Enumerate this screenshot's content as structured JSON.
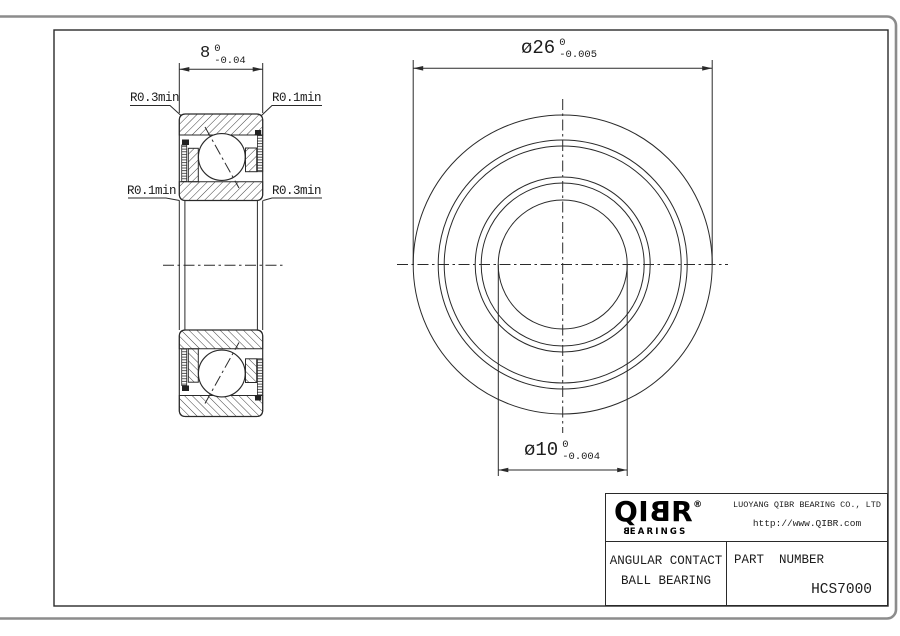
{
  "drawing": {
    "side_view": {
      "width_dim": {
        "value": "8",
        "tol_upper": "0",
        "tol_lower": "-0.04"
      },
      "radius_labels": {
        "top_left": "R0.3min",
        "top_right": "R0.1min",
        "bottom_left": "R0.1min",
        "bottom_right": "R0.3min"
      }
    },
    "front_view": {
      "outer_dia_dim": {
        "value": "ø26",
        "tol_upper": "0",
        "tol_lower": "-0.005"
      },
      "bore_dia_dim": {
        "value": "ø10",
        "tol_upper": "0",
        "tol_lower": "-0.004"
      }
    }
  },
  "title_block": {
    "logo": {
      "prefix": "QI",
      "mirrored_letter": "B",
      "suffix": "R",
      "registered": "®",
      "sub_mirrored": "B",
      "sub_rest": "EARINGS"
    },
    "company": "LUOYANG QIBR BEARING CO., LTD",
    "website": "http://www.QIBR.com",
    "product_line1": "ANGULAR CONTACT",
    "product_line2": "BALL BEARING",
    "part_number_label": "PART  NUMBER",
    "part_number": "HCS7000"
  }
}
